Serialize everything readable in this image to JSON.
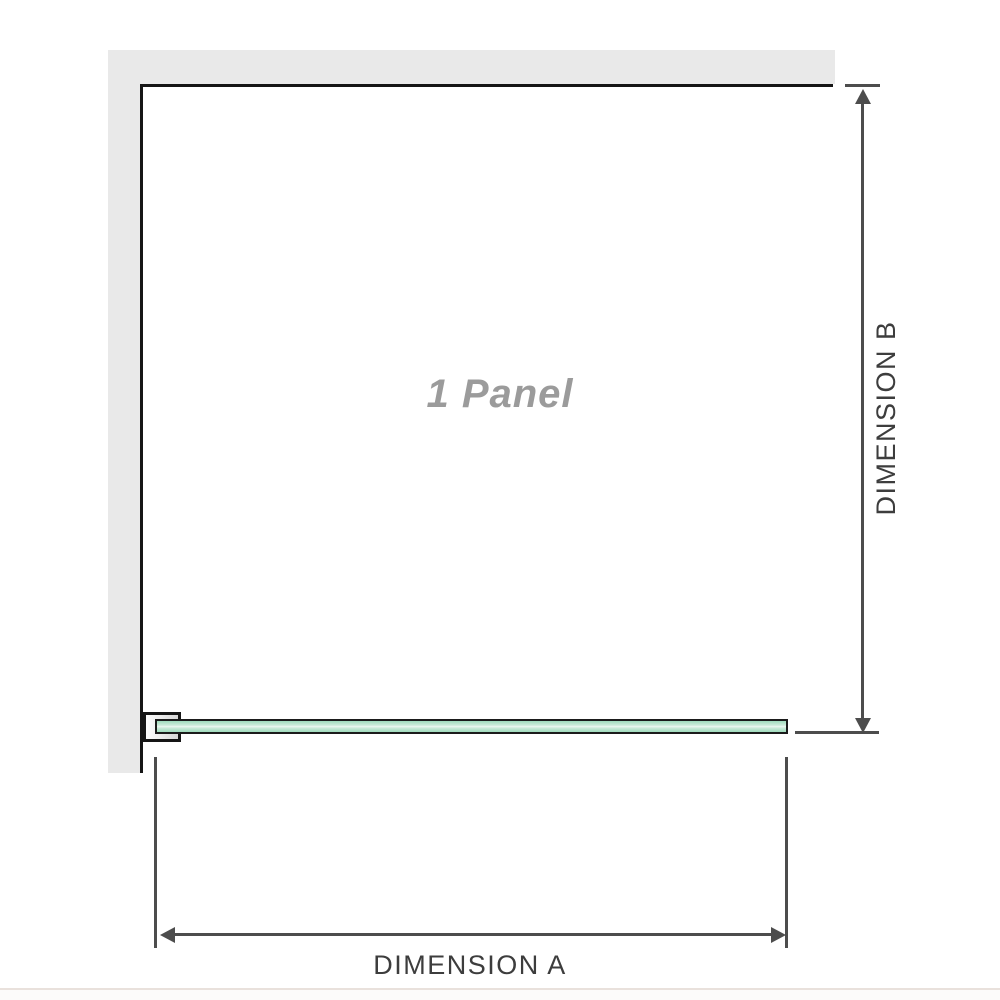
{
  "diagram": {
    "panel_label": "1 Panel",
    "dimension_a": {
      "label": "DIMENSION A"
    },
    "dimension_b": {
      "label": "DIMENSION B"
    },
    "colors": {
      "wall_fill": "#e9e9e9",
      "edge": "#151515",
      "line": "#4d4d4d",
      "text": "#3d3d3d",
      "panel_text": "#9b9b9b",
      "glass_mid": "#9edbbc",
      "glass_light": "#cdecdb",
      "glass_border": "#1b1b1b",
      "divider": "#e9e1dc"
    }
  }
}
